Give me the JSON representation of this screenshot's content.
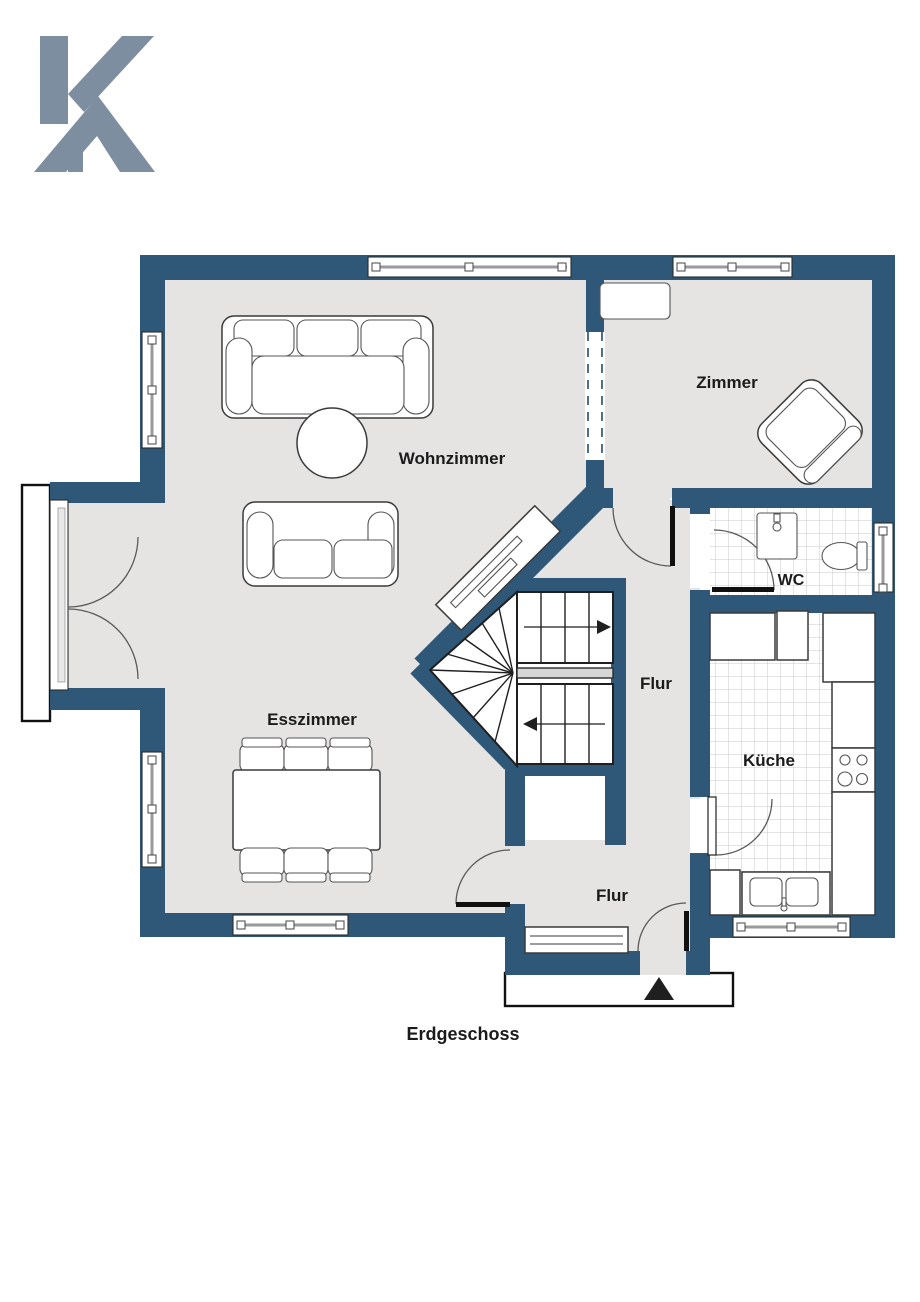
{
  "logo": {
    "name": "K house logo",
    "color": "#7d8ea0"
  },
  "floorplan": {
    "colors": {
      "wall": "#2f5878",
      "floor": "#e5e4e2",
      "tile_line": "#c9c9c9"
    },
    "labels": {
      "wohnzimmer": "Wohnzimmer",
      "zimmer": "Zimmer",
      "wc": "WC",
      "flur_upper": "Flur",
      "kueche": "Küche",
      "esszimmer": "Esszimmer",
      "flur_lower": "Flur",
      "caption": "Erdgeschoss"
    }
  }
}
